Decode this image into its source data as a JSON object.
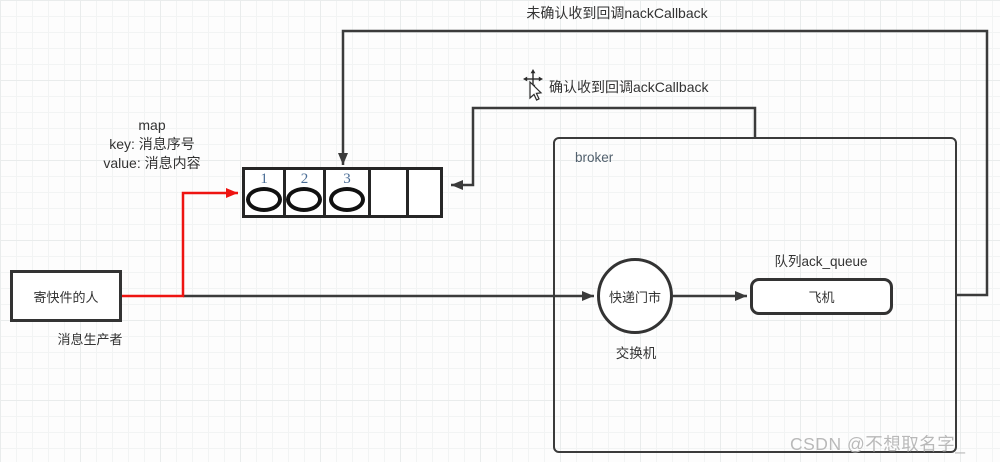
{
  "colors": {
    "line": "#3b3b3b",
    "red_line": "#ee1411",
    "queue_number": "#4a6d96",
    "text": "#333333",
    "broker_text": "#52616e",
    "watermark": "#b9b9b9"
  },
  "labels": {
    "nack": "未确认收到回调nackCallback",
    "ack": "确认收到回调ackCallback"
  },
  "map": {
    "title": "map",
    "key": "key: 消息序号",
    "value": "value: 消息内容"
  },
  "producer": {
    "box_label": "寄快件的人",
    "caption": "消息生产者"
  },
  "queue": {
    "cells": [
      {
        "num": "1"
      },
      {
        "num": "2"
      },
      {
        "num": "3"
      },
      {
        "num": ""
      },
      {
        "num": ""
      }
    ]
  },
  "broker": {
    "title": "broker",
    "exchange_label": "快递门市",
    "exchange_caption": "交换机",
    "queue_caption": "队列ack_queue",
    "queue_box_label": "飞机"
  },
  "watermark": "CSDN @不想取名字_"
}
